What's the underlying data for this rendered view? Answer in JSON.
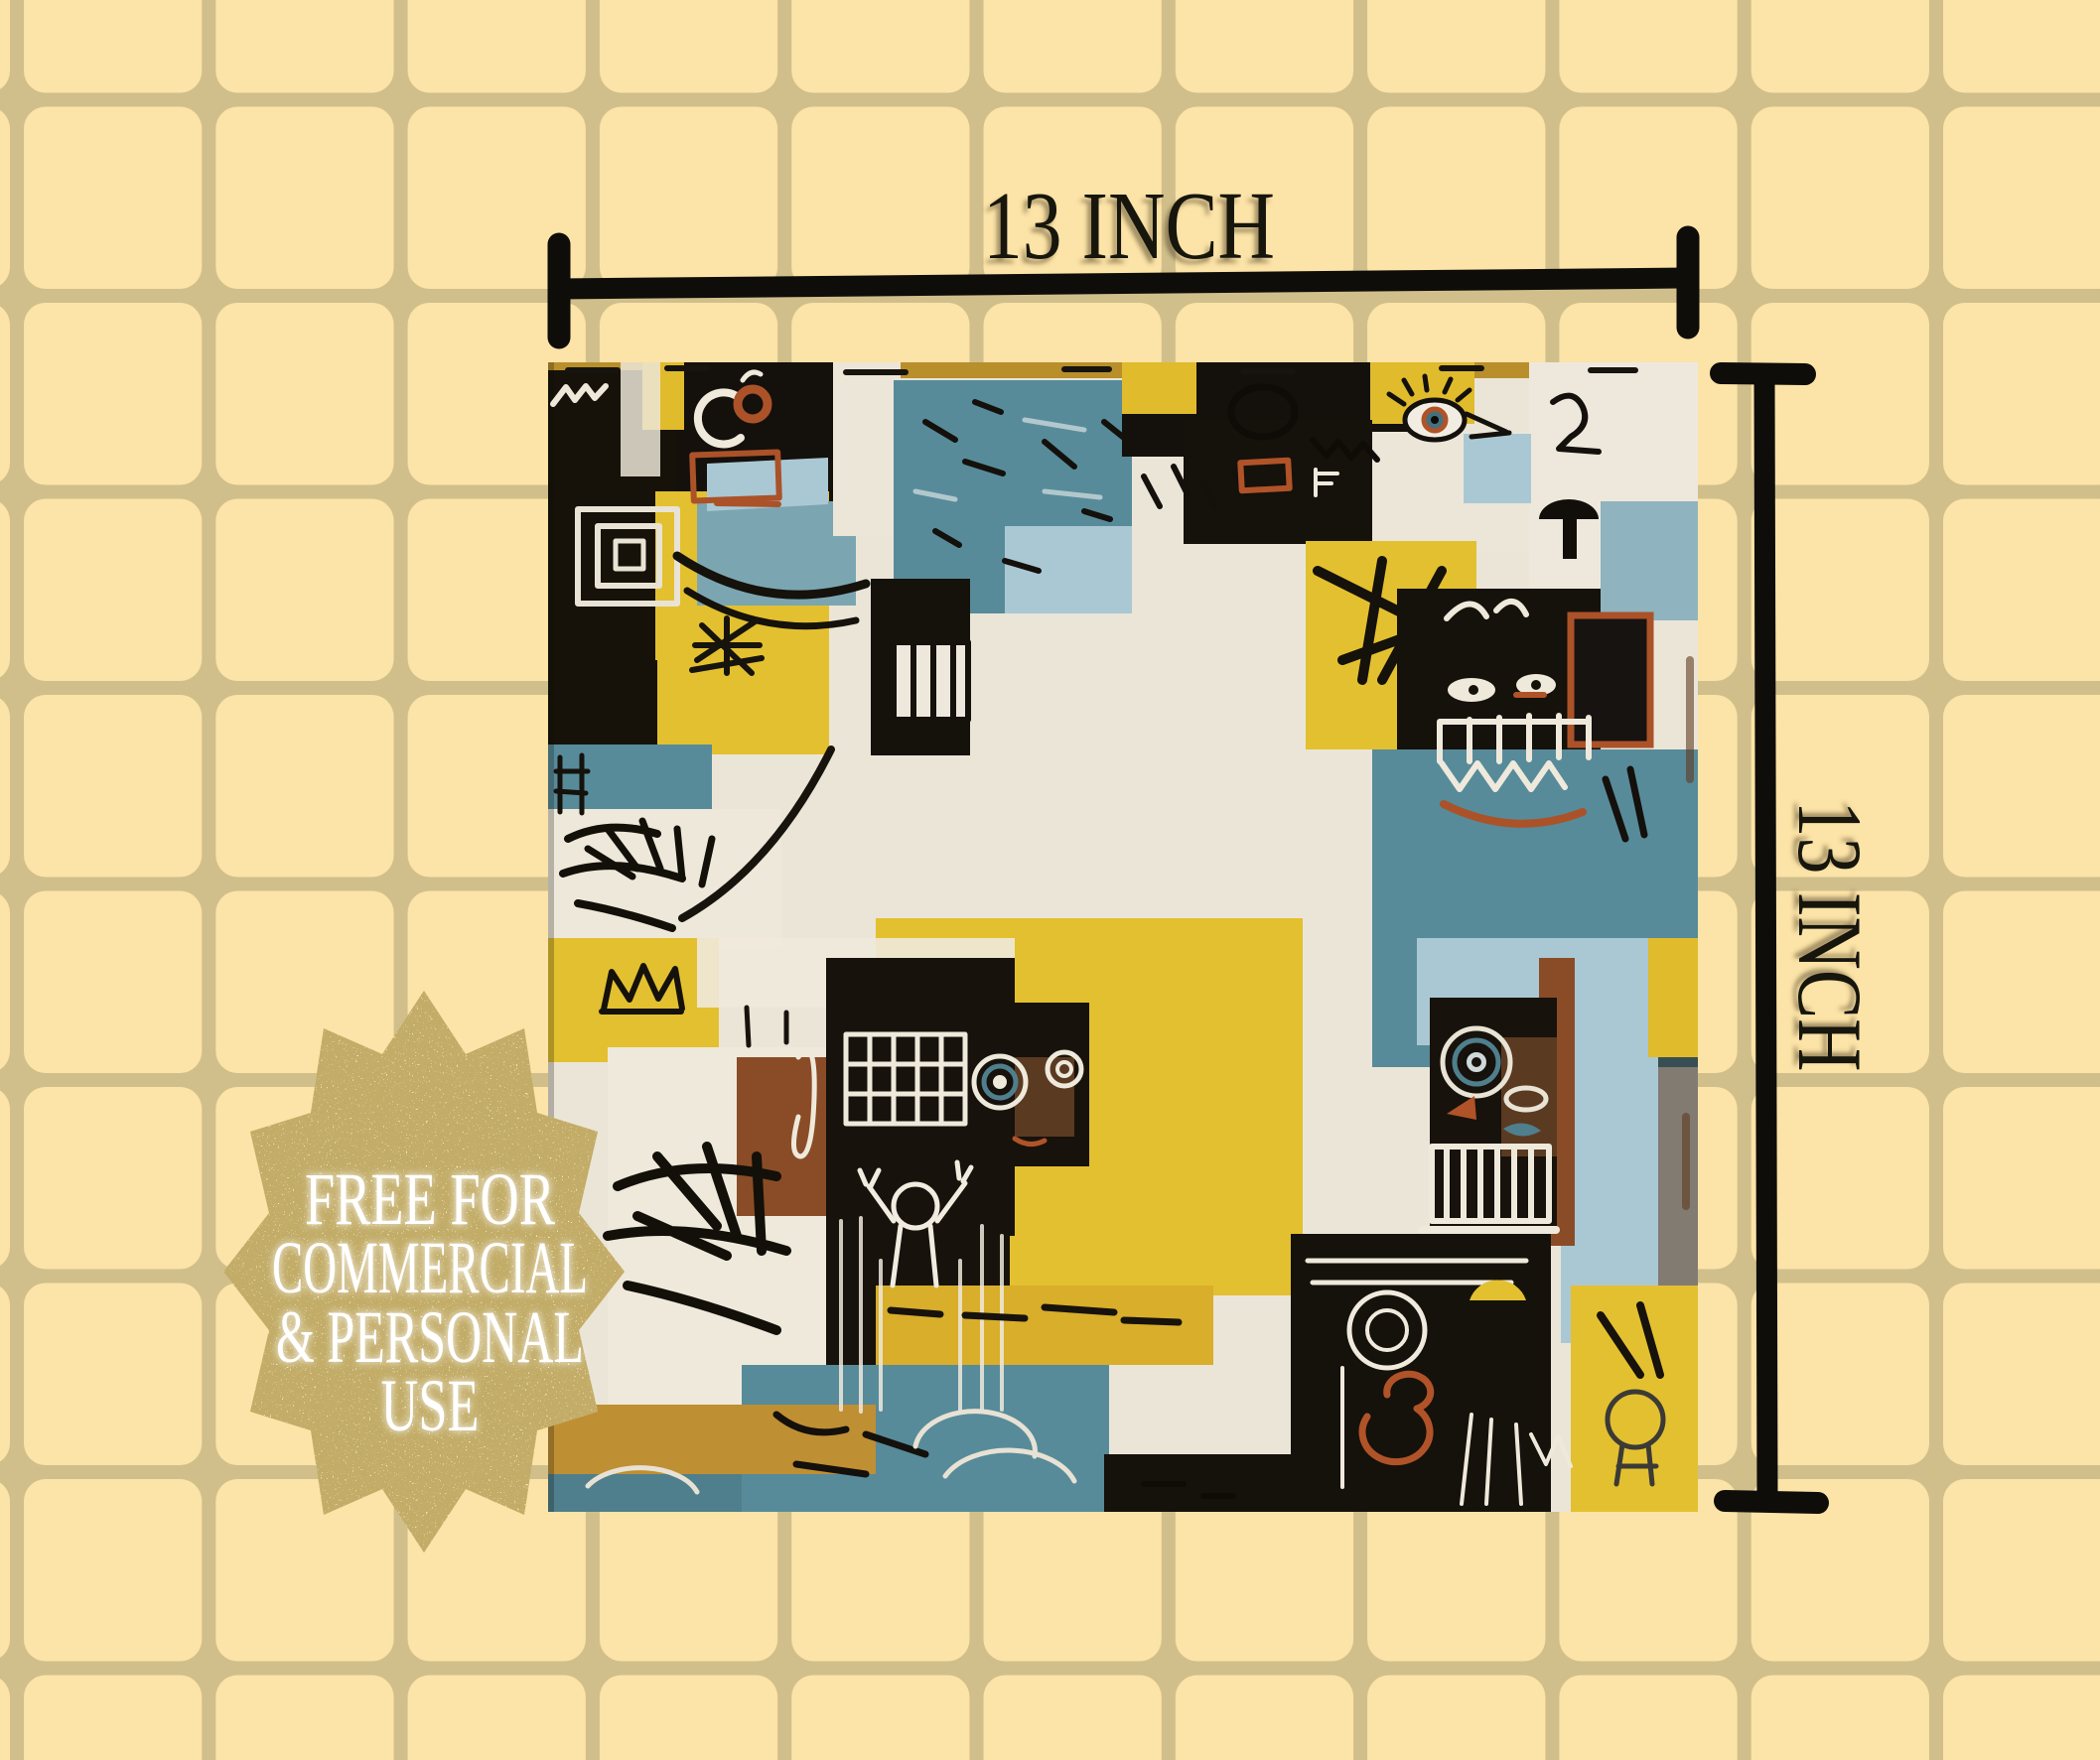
{
  "page": {
    "kind": "digital-paper product mockup",
    "background": {
      "tile_color": "#fce3a7",
      "grout_color": "#d0bf8b"
    }
  },
  "dimension_annotations": {
    "top_label": "13 INCH",
    "right_label": "13 INCH",
    "line_color": "#0f0d0a"
  },
  "badge": {
    "shape": "12-point gold glitter starburst seal",
    "gold_color": "#c79d45",
    "text_color": "#ffffff",
    "lines": [
      "FREE FOR",
      "COMMERCIAL",
      "& PERSONAL",
      "USE"
    ]
  },
  "artwork": {
    "description": "Square 13x13 inch abstract neo-expressionist graffiti style pattern swatch with crowns, eyes, grinning teeth faces, window grids, palm scribbles and stick figures",
    "palette": {
      "teal": "#578b9a",
      "light_blue": "#abc9d6",
      "yellow": "#e2bf31",
      "mustard": "#c1952c",
      "black": "#15110c",
      "off_white": "#ece6d8",
      "rust": "#ab5229",
      "brown": "#5f3a20"
    }
  }
}
